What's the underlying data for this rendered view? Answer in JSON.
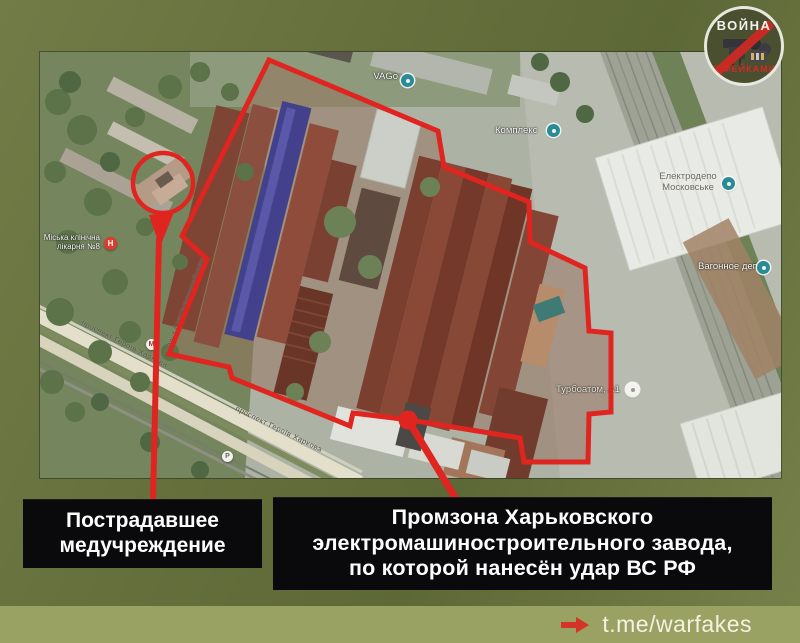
{
  "branding": {
    "logo": {
      "top": "ВОЙНА",
      "bottom": "С ФЕЙКАМИ"
    },
    "footer": {
      "handle": "t.me/warfakes"
    }
  },
  "callouts": {
    "hospital": {
      "label": "Пострадавшее\nмедучреждение"
    },
    "factory": {
      "label": "Промзона Харьковского\nэлектромашиностроительного завода,\nпо которой нанесён удар ВС РФ"
    }
  },
  "map": {
    "labels": {
      "vago": "VAGo",
      "komplex": "Комплекс",
      "depot": "Електродепо\nМосковське",
      "wagon_depot": "Вагонное депо",
      "turboatom": "Турбоатом, А1",
      "hospital": "Міська клінічна\nлікарня №8",
      "street1": "проспект Героїв Харкова",
      "street2": "проспект Героїв Харкова",
      "street3": "вулиця Електромашинобудівна"
    },
    "markers": {
      "hospital": "Н",
      "metro": "М",
      "parking": "Р"
    }
  },
  "colors": {
    "accent_red": "#e02420",
    "background_olive": "#6b7641",
    "footer_strip": "#99a263",
    "callout_box": "#0a0a0d",
    "pin_teal": "#2a8b95"
  }
}
